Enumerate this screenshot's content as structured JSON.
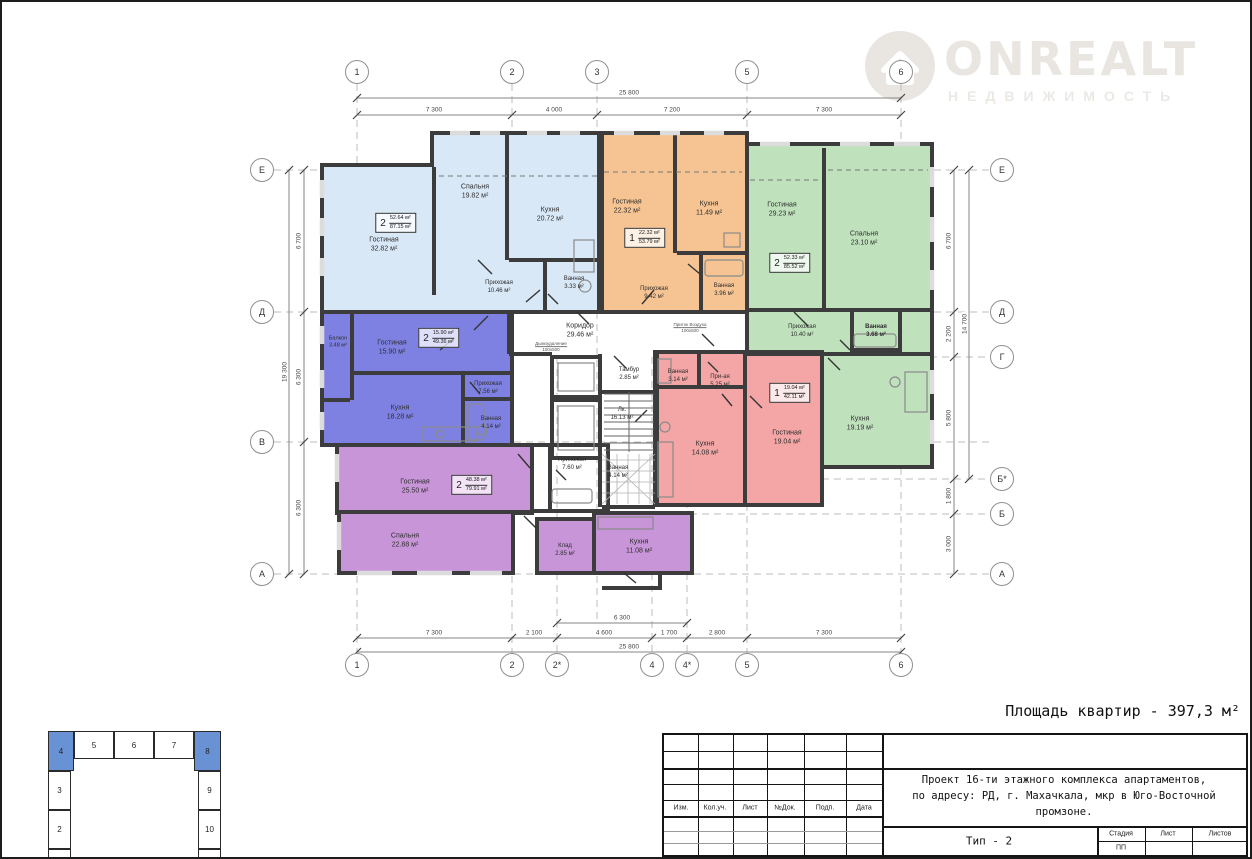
{
  "logo": {
    "title": "ONREALT",
    "subtitle": "НЕДВИЖИМОСТЬ"
  },
  "summary": "Площадь квартир - 397,3 м²",
  "grid": {
    "axes": {
      "top": [
        "1",
        "2",
        "3",
        "5",
        "6"
      ],
      "bottom": [
        "1",
        "2",
        "2*",
        "4",
        "4*",
        "5",
        "6"
      ],
      "left": [
        "Е",
        "Д",
        "В",
        "А"
      ],
      "right": [
        "Е",
        "Д",
        "Г",
        "Б*",
        "Б",
        "А"
      ]
    },
    "dims": {
      "top_total": "25 800",
      "top": [
        "7 300",
        "4 000",
        "7 200",
        "7 300"
      ],
      "bottom": [
        "7 300",
        "2 100",
        "4 600",
        "1 700",
        "2 800",
        "7 300"
      ],
      "bottom_span": "6 300",
      "bottom_total": "25 800",
      "left": [
        "6 700",
        "6 300",
        "6 300"
      ],
      "left_total": "19 300",
      "right": [
        "6 700",
        "2 200",
        "5 800",
        "1 800",
        "3 000"
      ],
      "right_total": "14 700"
    }
  },
  "plan": {
    "apartments": {
      "blue2": {
        "color": "#d9e8f7",
        "tag": {
          "rooms": "2",
          "living": "52.64 м²",
          "total": "87.15 м²"
        },
        "rooms": {
          "living": {
            "name": "Гостиная",
            "area": "32.82 м²"
          },
          "bedroom": {
            "name": "Спальня",
            "area": "19.82 м²"
          },
          "kitchen": {
            "name": "Кухня",
            "area": "20.72 м²"
          },
          "hall": {
            "name": "Прихожая",
            "area": "10.46 м²"
          },
          "bath": {
            "name": "Ванная",
            "area": "3.33 м²"
          }
        }
      },
      "orange1": {
        "color": "#f6c493",
        "tag": {
          "rooms": "1",
          "living": "22.32 м²",
          "total": "53.79 м²"
        },
        "rooms": {
          "living": {
            "name": "Гостиная",
            "area": "22.32 м²"
          },
          "kitchen": {
            "name": "Кухня",
            "area": "11.49 м²"
          },
          "hall": {
            "name": "Прихожая",
            "area": "9.42 м²"
          },
          "bath": {
            "name": "Ванная",
            "area": "3.96 м²"
          }
        }
      },
      "green2": {
        "color": "#bfe2bd",
        "tag": {
          "rooms": "2",
          "living": "52.33 м²",
          "total": "85.52 м²"
        },
        "rooms": {
          "living": {
            "name": "Гостиная",
            "area": "29.23 м²"
          },
          "bedroom": {
            "name": "Спальня",
            "area": "23.10 м²"
          },
          "hall": {
            "name": "Прихожая",
            "area": "10.40 м²"
          },
          "bath": {
            "name": "Ванная",
            "area": "3.68 м²"
          },
          "kitchen": {
            "name": "Кухня",
            "area": "19.19 м²"
          }
        }
      },
      "indigo2": {
        "color": "#7e81e2",
        "tag": {
          "rooms": "2",
          "living": "15.90 м²",
          "total": "49.36 м²"
        },
        "rooms": {
          "balcony": {
            "name": "Балкон",
            "area": "3.48 м²"
          },
          "living": {
            "name": "Гостиная",
            "area": "15.90 м²"
          },
          "hall": {
            "name": "Прихожая",
            "area": "7.56 м²"
          },
          "kitchen": {
            "name": "Кухня",
            "area": "18.28 м²"
          },
          "bath": {
            "name": "Ванная",
            "area": "4.14 м²"
          }
        }
      },
      "violet2": {
        "color": "#c995d9",
        "tag": {
          "rooms": "2",
          "living": "48.38 м²",
          "total": "79.91 м²"
        },
        "rooms": {
          "living": {
            "name": "Гостиная",
            "area": "25.50 м²"
          },
          "bedroom": {
            "name": "Спальня",
            "area": "22.88 м²"
          },
          "storage": {
            "name": "Клад",
            "area": "2.85 м²"
          },
          "kitchen": {
            "name": "Кухня",
            "area": "11.08 м²"
          },
          "hall": {
            "name": "Прихожая",
            "area": "7.60 м²"
          },
          "bath": {
            "name": "Ванная",
            "area": "4.14 м²"
          }
        }
      },
      "pink1": {
        "color": "#f4a6a6",
        "tag": {
          "rooms": "1",
          "living": "19.04 м²",
          "total": "42.11 м²"
        },
        "rooms": {
          "bath": {
            "name": "Ванная",
            "area": "3.14 м²"
          },
          "hall": {
            "name": "При-ая",
            "area": "5.25 м²"
          },
          "living": {
            "name": "Гостиная",
            "area": "19.04 м²"
          },
          "kitchen": {
            "name": "Кухня",
            "area": "14.08 м²"
          }
        }
      }
    },
    "common": {
      "corridor": {
        "name": "Коридор",
        "area": "29.46 м²"
      },
      "tambour": {
        "name": "Тамбур",
        "area": "2.85 м²"
      },
      "stair": {
        "name": "Лк.",
        "area": "16.13 м²"
      }
    },
    "vents": {
      "smoke": {
        "name": "Дымоудаление",
        "size": "100х500"
      },
      "air": {
        "name": "Приток Воздуха",
        "size": "100х500"
      }
    }
  },
  "keyplan": {
    "top": [
      "4",
      "5",
      "6",
      "7",
      "8"
    ],
    "left": [
      "3",
      "2"
    ],
    "right": [
      "9",
      "10"
    ],
    "highlighted": [
      "4",
      "8"
    ],
    "highlight_color": "#6992d4"
  },
  "titleblock": {
    "cols": [
      "Изм.",
      "Кол.уч.",
      "Лист",
      "№Док.",
      "Подп.",
      "Дата"
    ],
    "project_line1": "Проект 16-ти этажного комплекса апартаментов,",
    "project_line2": "по адресу: РД, г. Махачкала, мкр в Юго-Восточной промзоне.",
    "type_label": "Тип - 2",
    "stage_cols": [
      "Стадия",
      "Лист",
      "Листов"
    ],
    "stage_value": "ПП"
  }
}
